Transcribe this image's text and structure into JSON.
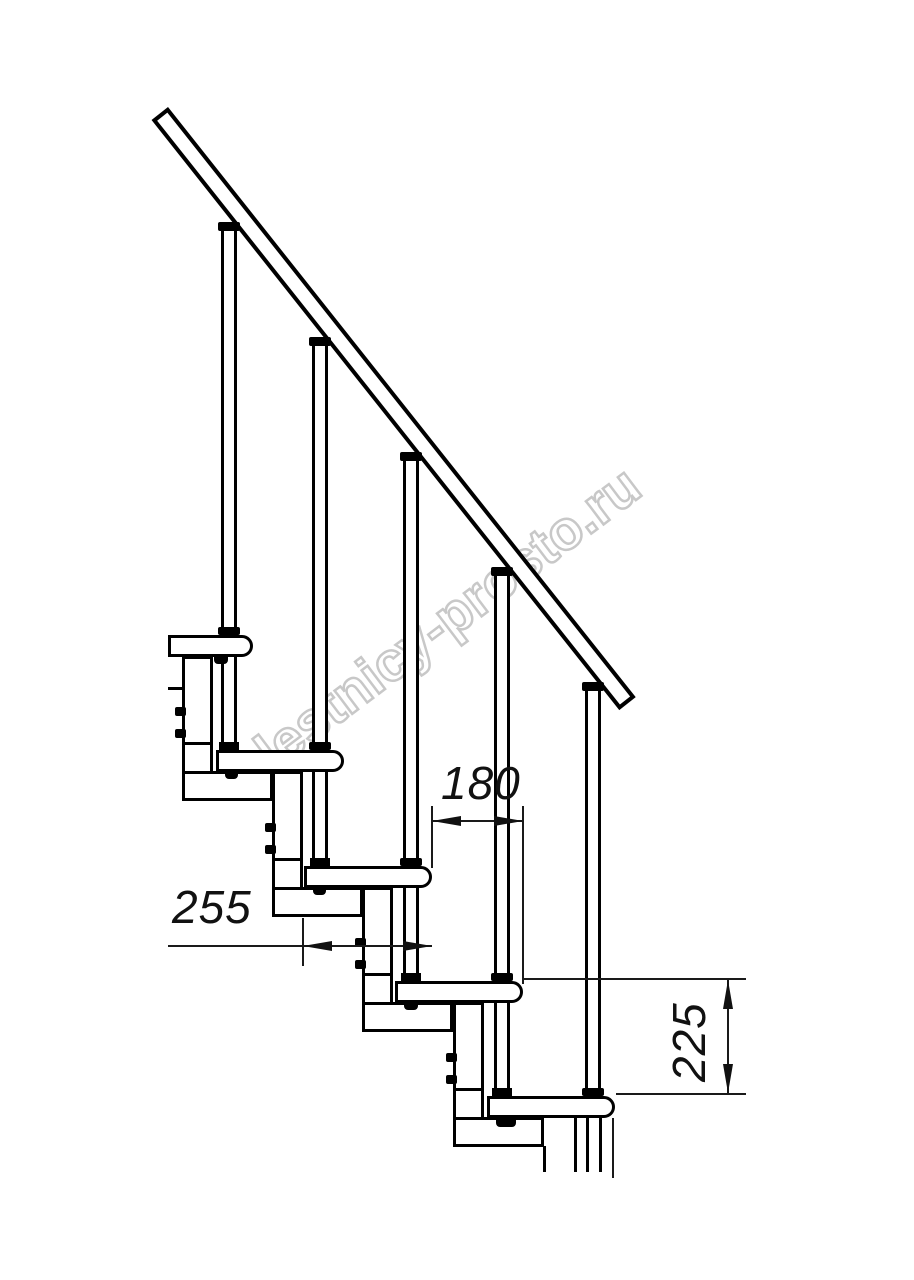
{
  "drawing": {
    "type": "modular-staircase-side-elevation",
    "steps_visible": 5,
    "balusters_visible": 5,
    "colors": {
      "line": "#000000",
      "dimension_line": "#111111",
      "watermark_outline": "#c8c8c8",
      "background": "#ffffff"
    }
  },
  "watermark": {
    "text": "lestnicy-prosto.ru"
  },
  "dimensions": {
    "tread_overhang": {
      "value": "180"
    },
    "tread_depth": {
      "value": "255"
    },
    "step_rise": {
      "value": "225"
    }
  }
}
